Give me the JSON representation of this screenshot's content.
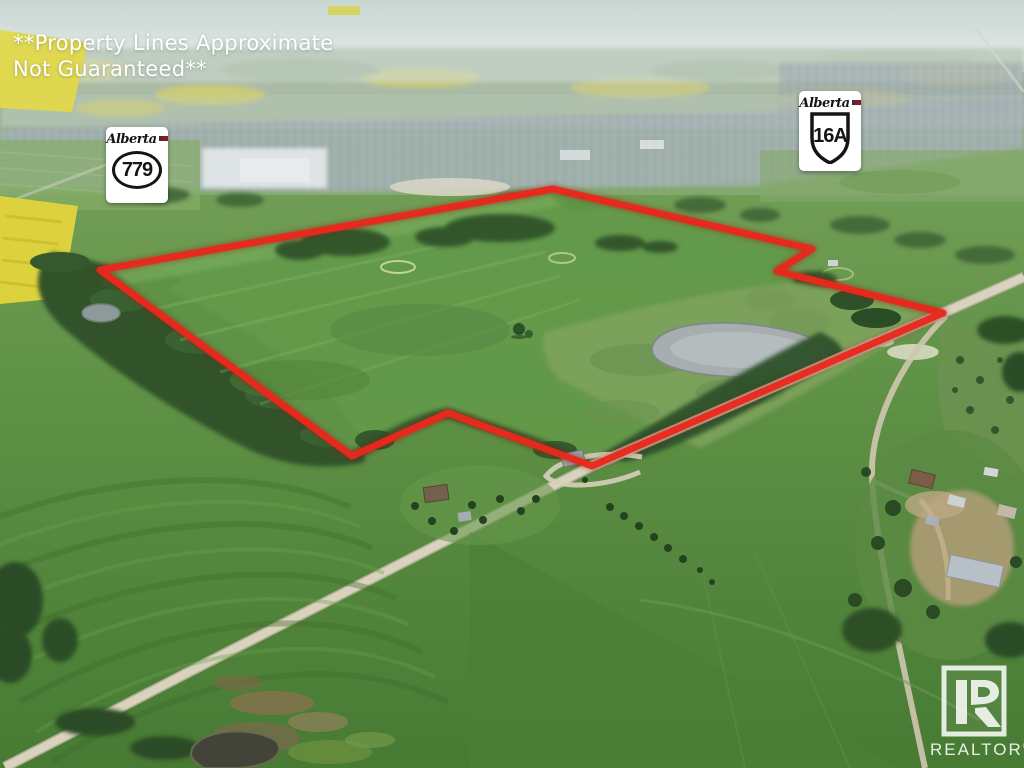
{
  "overlay": {
    "disclaimer": {
      "line1": "**Property Lines Approximate",
      "line2": "Not Guaranteed**"
    }
  },
  "shields": {
    "s779": {
      "region": "Alberta",
      "number": "779"
    },
    "s16a": {
      "region": "Alberta",
      "number": "16A"
    }
  },
  "watermark": {
    "label": "REALTOR",
    "registered": "®"
  },
  "colors": {
    "boundary_red": "#e8281d",
    "boundary_glow": "#a01410",
    "shield_background": "#ffffff",
    "shield_ink": "#151515",
    "disclaimer_white": "#ffffff",
    "watermark_white": "rgba(255,255,255,0.85)",
    "canola_yellow": "#ded33f",
    "field_green": "#5f9546",
    "tree_green": "#2f5129",
    "pond_gray": "#a6aeb0",
    "road_tan": "#dbd4c0"
  }
}
